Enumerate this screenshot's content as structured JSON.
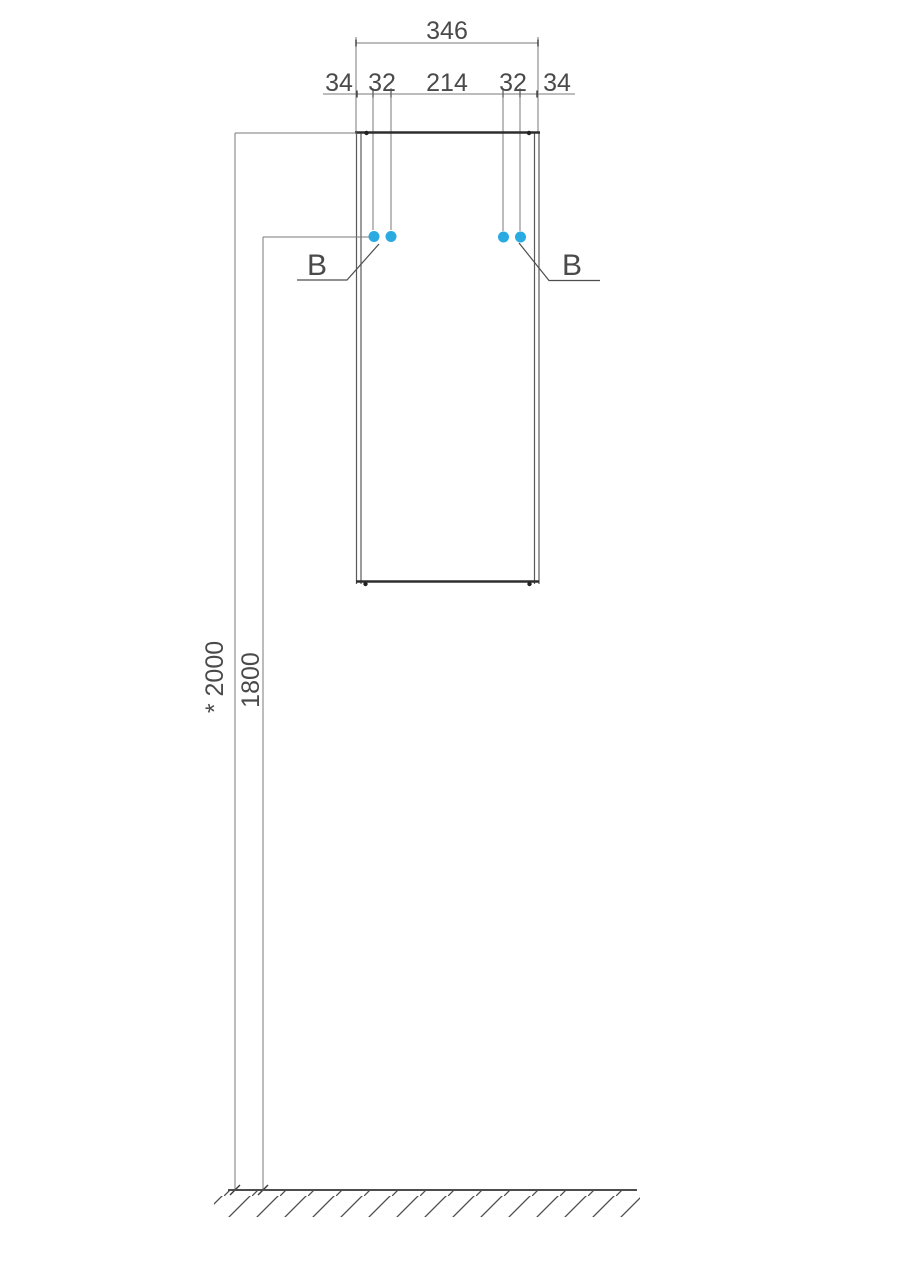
{
  "dims": {
    "total_width": "346",
    "segments": [
      "34",
      "32",
      "214",
      "32",
      "34"
    ],
    "height_to_top": "* 2000",
    "height_to_mount": "1800"
  },
  "labels": {
    "mount_left": "B",
    "mount_right": "B"
  },
  "colors": {
    "mount_point": "#29abe2",
    "line": "#787878",
    "edge": "#2e2e2e",
    "text": "#4a4a4a"
  }
}
